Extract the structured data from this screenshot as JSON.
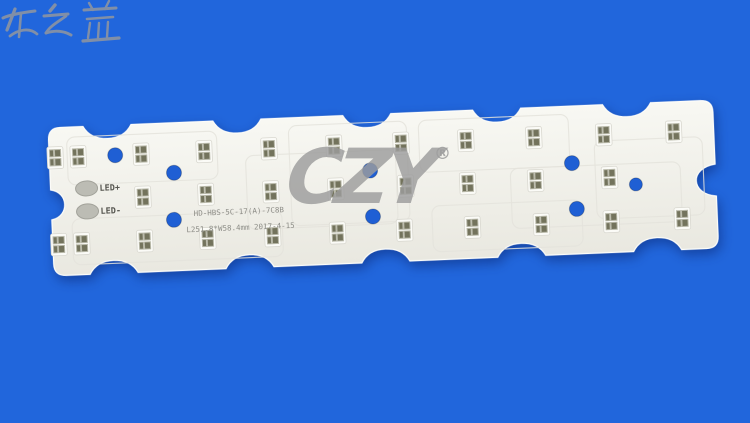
{
  "background": {
    "color": "#2166DC"
  },
  "watermark": {
    "brand": "CZY",
    "registered": "®",
    "cjk_text": "诚之益",
    "color": "#9d9d9d"
  },
  "board": {
    "surface_top_color": "#f8f8f3",
    "surface_bottom_color": "#e9e8e0",
    "edge_color": "#fdfdfa",
    "trace_color": "#e4e3dc",
    "labels": {
      "led_plus": "LED+",
      "led_minus": "LED-"
    },
    "silkscreen": {
      "line1": "HD-HBS-5C-17(A)-7C8B",
      "line2": "L251.8*W58.4mm 2017-4-15",
      "color": "#8e8e88"
    },
    "geometry": {
      "x": 48,
      "y": 128,
      "width": 665,
      "height": 148,
      "rotation_deg": -2.4,
      "corner_radius": 12,
      "notch_halfwidth": 24,
      "notch_depth": 13,
      "top_notches": [
        59,
        189,
        319,
        449,
        579
      ],
      "bottom_notches": [
        60,
        196,
        332,
        468,
        604
      ],
      "left_notch": {
        "cy": 77,
        "depth": 18,
        "halfheight": 15
      },
      "right_notch": {
        "cy": 80,
        "depth": 26,
        "halfheight": 16
      }
    },
    "traces": [
      {
        "x": 18,
        "y": 10,
        "w": 150,
        "h": 48
      },
      {
        "x": 196,
        "y": 36,
        "w": 150,
        "h": 74
      },
      {
        "x": 20,
        "y": 92,
        "w": 210,
        "h": 46
      },
      {
        "x": 370,
        "y": 8,
        "w": 150,
        "h": 52
      },
      {
        "x": 545,
        "y": 36,
        "w": 108,
        "h": 78
      },
      {
        "x": 380,
        "y": 94,
        "w": 150,
        "h": 46
      },
      {
        "x": 240,
        "y": 8,
        "w": 118,
        "h": 100
      },
      {
        "x": 460,
        "y": 60,
        "w": 170,
        "h": 60
      }
    ],
    "led_footprints": {
      "base_color": "#fbfbf7",
      "base_border": "#d9d8d0",
      "pad_color": "#73735c",
      "pad_frame": "#b6b6a6",
      "rows": [
        {
          "name": "top",
          "y": 30,
          "xs": [
            6,
            29,
            92,
            155,
            220,
            285,
            352,
            417,
            485,
            555,
            625
          ]
        },
        {
          "name": "middle",
          "y": 73,
          "xs": [
            92,
            155,
            220,
            285,
            355,
            417,
            485,
            559
          ]
        },
        {
          "name": "bottom",
          "y": 117,
          "xs": [
            6,
            29,
            92,
            155,
            220,
            285,
            352,
            420,
            489,
            559,
            630
          ]
        }
      ]
    },
    "holes": {
      "color": "#1F5FD4",
      "items": [
        {
          "x": 66,
          "y": 30,
          "r": 7.5
        },
        {
          "x": 124,
          "y": 50,
          "r": 7.5
        },
        {
          "x": 122,
          "y": 97,
          "r": 7.5
        },
        {
          "x": 320,
          "y": 56,
          "r": 7.5
        },
        {
          "x": 321,
          "y": 102,
          "r": 7.5
        },
        {
          "x": 522,
          "y": 57,
          "r": 7.5
        },
        {
          "x": 525,
          "y": 103,
          "r": 7.5
        },
        {
          "x": 585,
          "y": 81,
          "r": 6.5
        }
      ]
    },
    "connector_pads": {
      "fill": "#bcbcb4",
      "stroke": "#a2a29a",
      "label_color": "#55554f",
      "items": [
        {
          "label_key": "led_plus",
          "x": 36,
          "y": 62
        },
        {
          "label_key": "led_minus",
          "x": 36,
          "y": 85
        }
      ]
    }
  }
}
